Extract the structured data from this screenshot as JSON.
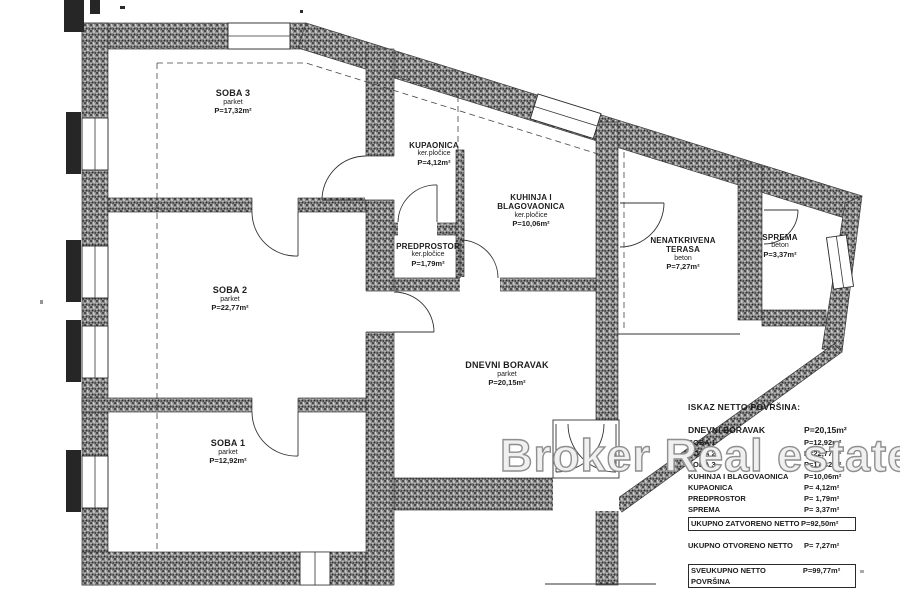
{
  "watermark": "Broker Real estate",
  "rooms": [
    {
      "name": "SOBA 3",
      "floor": "parket",
      "area": "P=17,32m²"
    },
    {
      "name": "KUPAONICA",
      "floor": "ker.pločice",
      "area": "P=4,12m²"
    },
    {
      "name": "KUHINJA I BLAGOVAONICA",
      "floor": "ker.pločice",
      "area": "P=10,06m²"
    },
    {
      "name": "PREDPROSTOR",
      "floor": "ker.pločice",
      "area": "P=1,79m²"
    },
    {
      "name": "SOBA 2",
      "floor": "parket",
      "area": "P=22,77m²"
    },
    {
      "name": "DNEVNI BORAVAK",
      "floor": "parket",
      "area": "P=20,15m²"
    },
    {
      "name": "SOBA 1",
      "floor": "parket",
      "area": "P=12,92m²"
    },
    {
      "name": "NENATKRIVENA TERASA",
      "floor": "beton",
      "area": "P=7,27m²"
    },
    {
      "name": "SPREMA",
      "floor": "beton",
      "area": "P=3,37m²"
    }
  ],
  "legend": {
    "title": "ISKAZ NETTO POVRŠINA:",
    "rows": [
      {
        "label": "DNEVNI BORAVAK",
        "value": "P=20,15m²"
      },
      {
        "label": "SOBA 1",
        "value": "P=12,92m²"
      },
      {
        "label": "SOBA 2",
        "value": "P=22,77m²"
      },
      {
        "label": "SOBA 3",
        "value": "P=17,32m²"
      },
      {
        "label": "KUHINJA I BLAGOVAONICA",
        "value": "P=10,06m²"
      },
      {
        "label": "KUPAONICA",
        "value": "P= 4,12m²"
      },
      {
        "label": "PREDPROSTOR",
        "value": "P= 1,79m²"
      },
      {
        "label": "SPREMA",
        "value": "P= 3,37m²"
      }
    ],
    "total_closed": {
      "label": "UKUPNO ZATVORENO NETTO",
      "value": "P=92,50m²"
    },
    "total_open": {
      "label": "UKUPNO OTVORENO NETTO",
      "value": "P= 7,27m²"
    },
    "grand_total": {
      "label": "SVEUKUPNO NETTO POVRŠINA",
      "value": "P=99,77m²"
    }
  }
}
